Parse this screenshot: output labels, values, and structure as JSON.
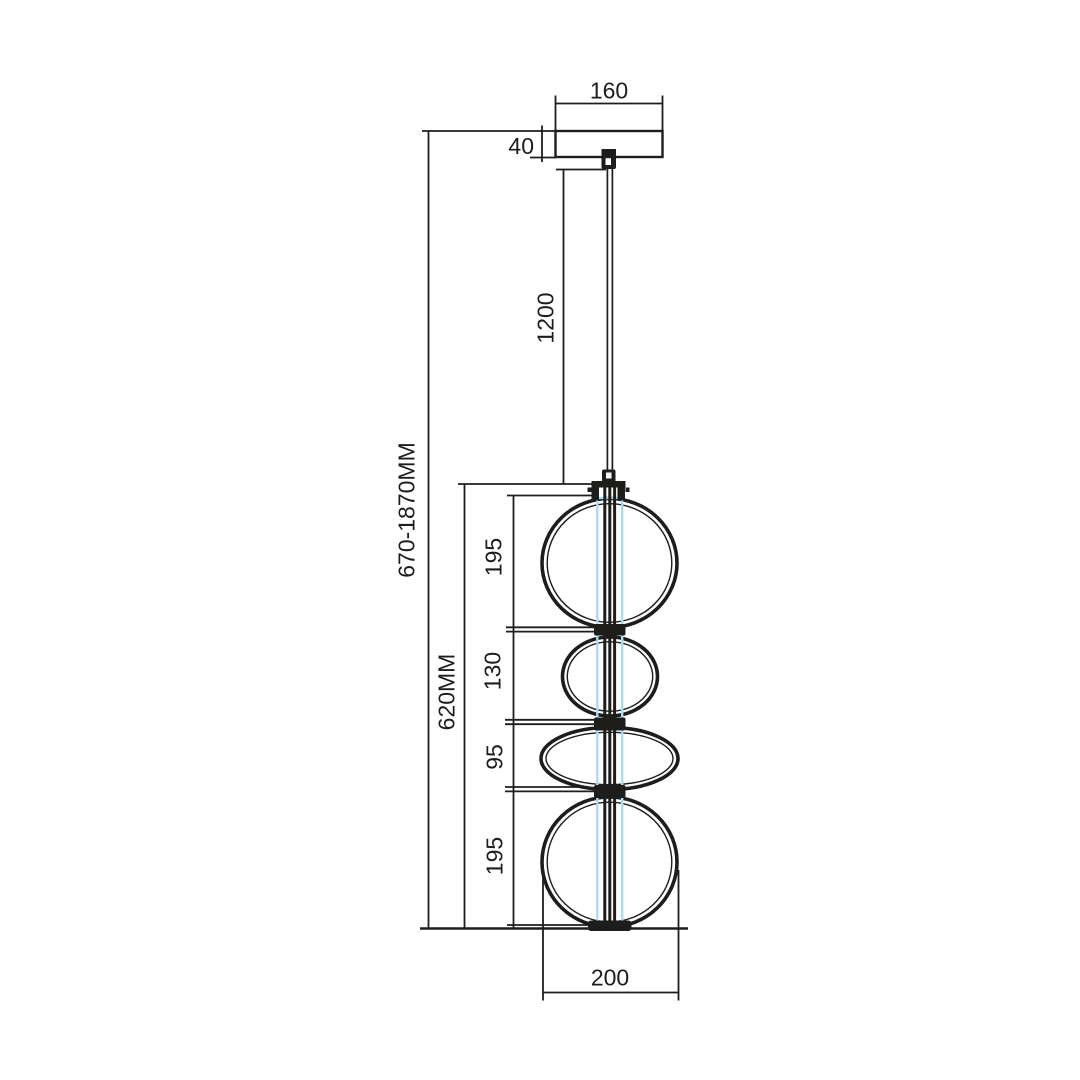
{
  "drawing": {
    "kind": "pendant-light-dimension-diagram",
    "units": "mm",
    "colors": {
      "line": "#1d1d1b",
      "led_tube": "#a9dcf3",
      "background": "#ffffff"
    },
    "labels": {
      "canopy_width": "160",
      "canopy_height": "40",
      "cable_length": "1200",
      "overall_height_range": "670-1870MM",
      "fixture_height": "620MM",
      "bubble1_height": "195",
      "bubble2_height": "130",
      "bubble3_height": "95",
      "bubble4_height": "195",
      "shade_diameter": "200"
    }
  }
}
